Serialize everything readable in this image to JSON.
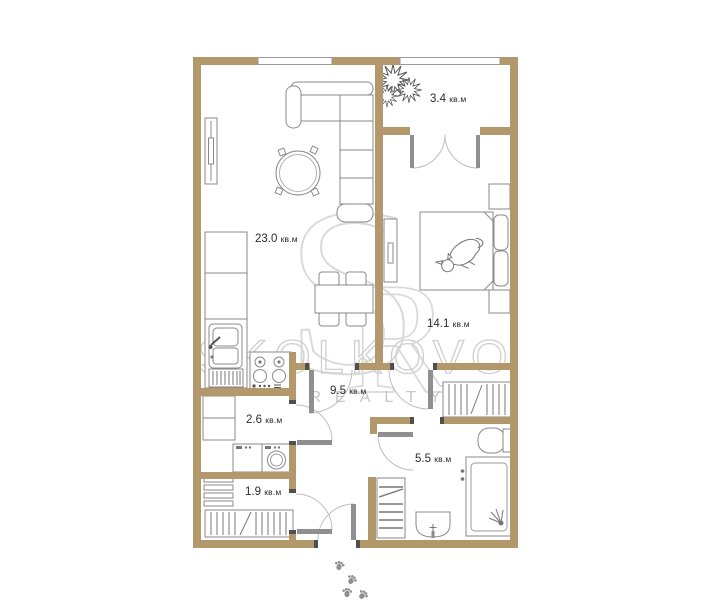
{
  "watermark": {
    "monogram_s": "S",
    "monogram_r": "R",
    "brand": "SKOLKOVO",
    "subtitle": "REALTY"
  },
  "colors": {
    "wall": "#b2986a",
    "furniture_line": "#8a8a8a",
    "door_leaf": "#8f8f8f",
    "door_jamb": "#4f4f4f",
    "label_text": "#2b2b2b",
    "watermark_line": "#d6d6d6"
  },
  "rooms": [
    {
      "name": "living-room-kitchen",
      "area": "23.0",
      "unit": "кв.м"
    },
    {
      "name": "balcony",
      "area": "3.4",
      "unit": "кв.м"
    },
    {
      "name": "bedroom",
      "area": "14.1",
      "unit": "кв.м"
    },
    {
      "name": "hallway",
      "area": "9.5",
      "unit": "кв.м"
    },
    {
      "name": "laundry",
      "area": "2.6",
      "unit": "кв.м"
    },
    {
      "name": "storage",
      "area": "1.9",
      "unit": "кв.м"
    },
    {
      "name": "bathroom",
      "area": "5.5",
      "unit": "кв.м"
    }
  ]
}
